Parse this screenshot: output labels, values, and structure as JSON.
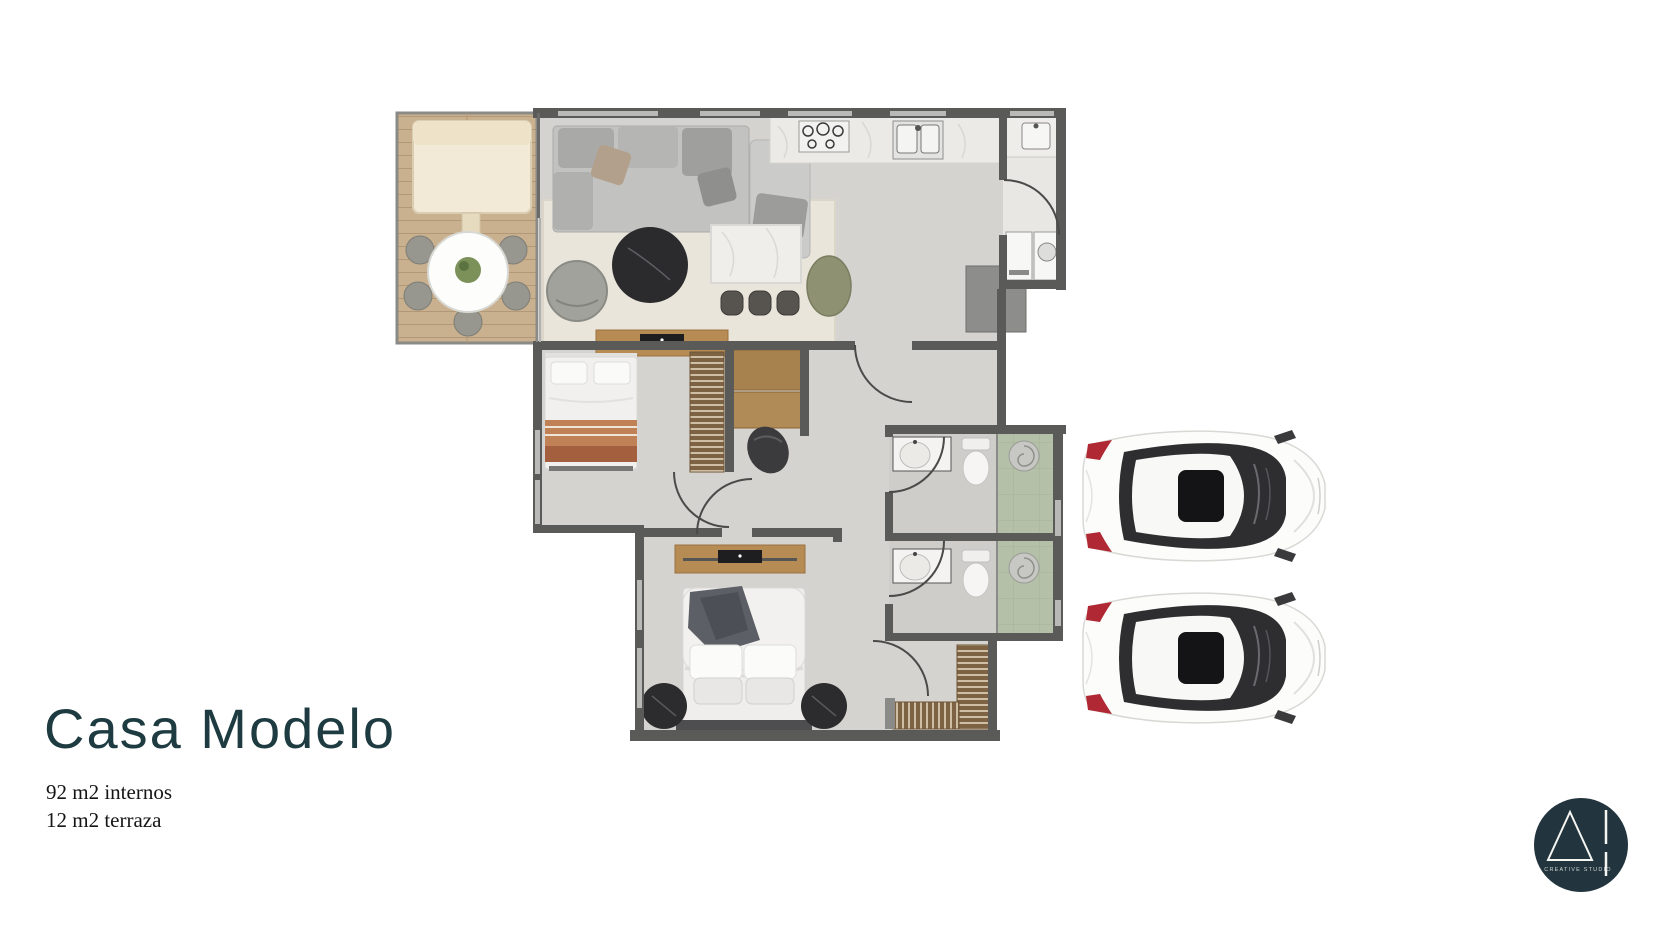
{
  "slide": {
    "title": "Casa Modelo",
    "area_lines": [
      "92 m2 internos",
      "12 m2 terraza"
    ]
  },
  "logo": {
    "studio_label": "CREATIVE STUDIO",
    "mark": "triangle-and-broken-bar"
  },
  "floorplan": {
    "depicted_rooms": [
      "terrace",
      "living-dining",
      "kitchen",
      "laundry",
      "bedroom-1",
      "bedroom-2",
      "bathroom-1",
      "bathroom-2",
      "hall"
    ],
    "parking_cars": 2
  },
  "colors": {
    "title_text": "#1d3b40",
    "body_text": "#151515",
    "logo_circle": "#22343d",
    "wall": "#5a5a58",
    "terrace_wood": "#c9b190",
    "floor_gray": "#d5d3cf",
    "marble": "#edecea",
    "shower_tile_green": "#b5c0a8",
    "accent_wood": "#b78c54",
    "car_taillight_red": "#b02833"
  }
}
